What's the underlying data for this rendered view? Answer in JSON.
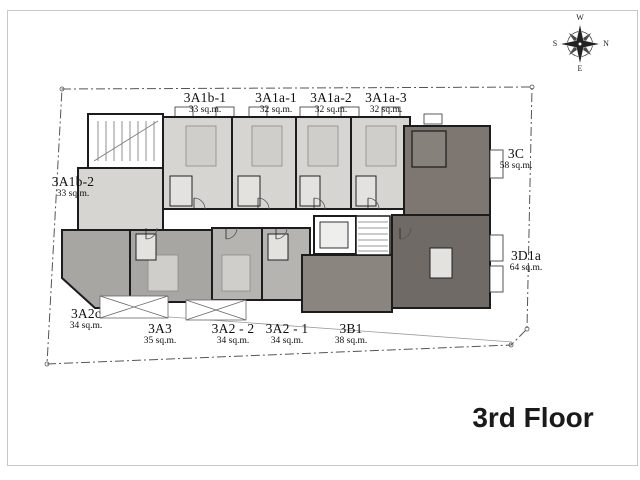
{
  "floor_label": "3rd Floor",
  "compass": {
    "top": "W",
    "right": "N",
    "bottom": "E",
    "left": "S"
  },
  "units": [
    {
      "name": "3A1b-1",
      "area": "33 sq.m."
    },
    {
      "name": "3A1a-1",
      "area": "32 sq.m."
    },
    {
      "name": "3A1a-2",
      "area": "32 sq.m."
    },
    {
      "name": "3A1a-3",
      "area": "32 sq.m."
    },
    {
      "name": "3A1b-2",
      "area": "33 sq.m."
    },
    {
      "name": "3C",
      "area": "58 sq.m."
    },
    {
      "name": "3D1a",
      "area": "64 sq.m."
    },
    {
      "name": "3A2c",
      "area": "34 sq.m."
    },
    {
      "name": "3A3",
      "area": "35 sq.m."
    },
    {
      "name": "3A2 - 2",
      "area": "34 sq.m."
    },
    {
      "name": "3A2 - 1",
      "area": "34 sq.m."
    },
    {
      "name": "3B1",
      "area": "38 sq.m."
    }
  ],
  "colors": {
    "unit_light": "#d6d5d1",
    "unit_medium": "#a7a6a3",
    "unit_medium_light": "#b5b4b1",
    "unit_b1": "#8b8580",
    "unit_c": "#7d7671",
    "unit_darkest": "#6f6a66",
    "wall": "#1c1c1c",
    "boundary": "#555555"
  }
}
